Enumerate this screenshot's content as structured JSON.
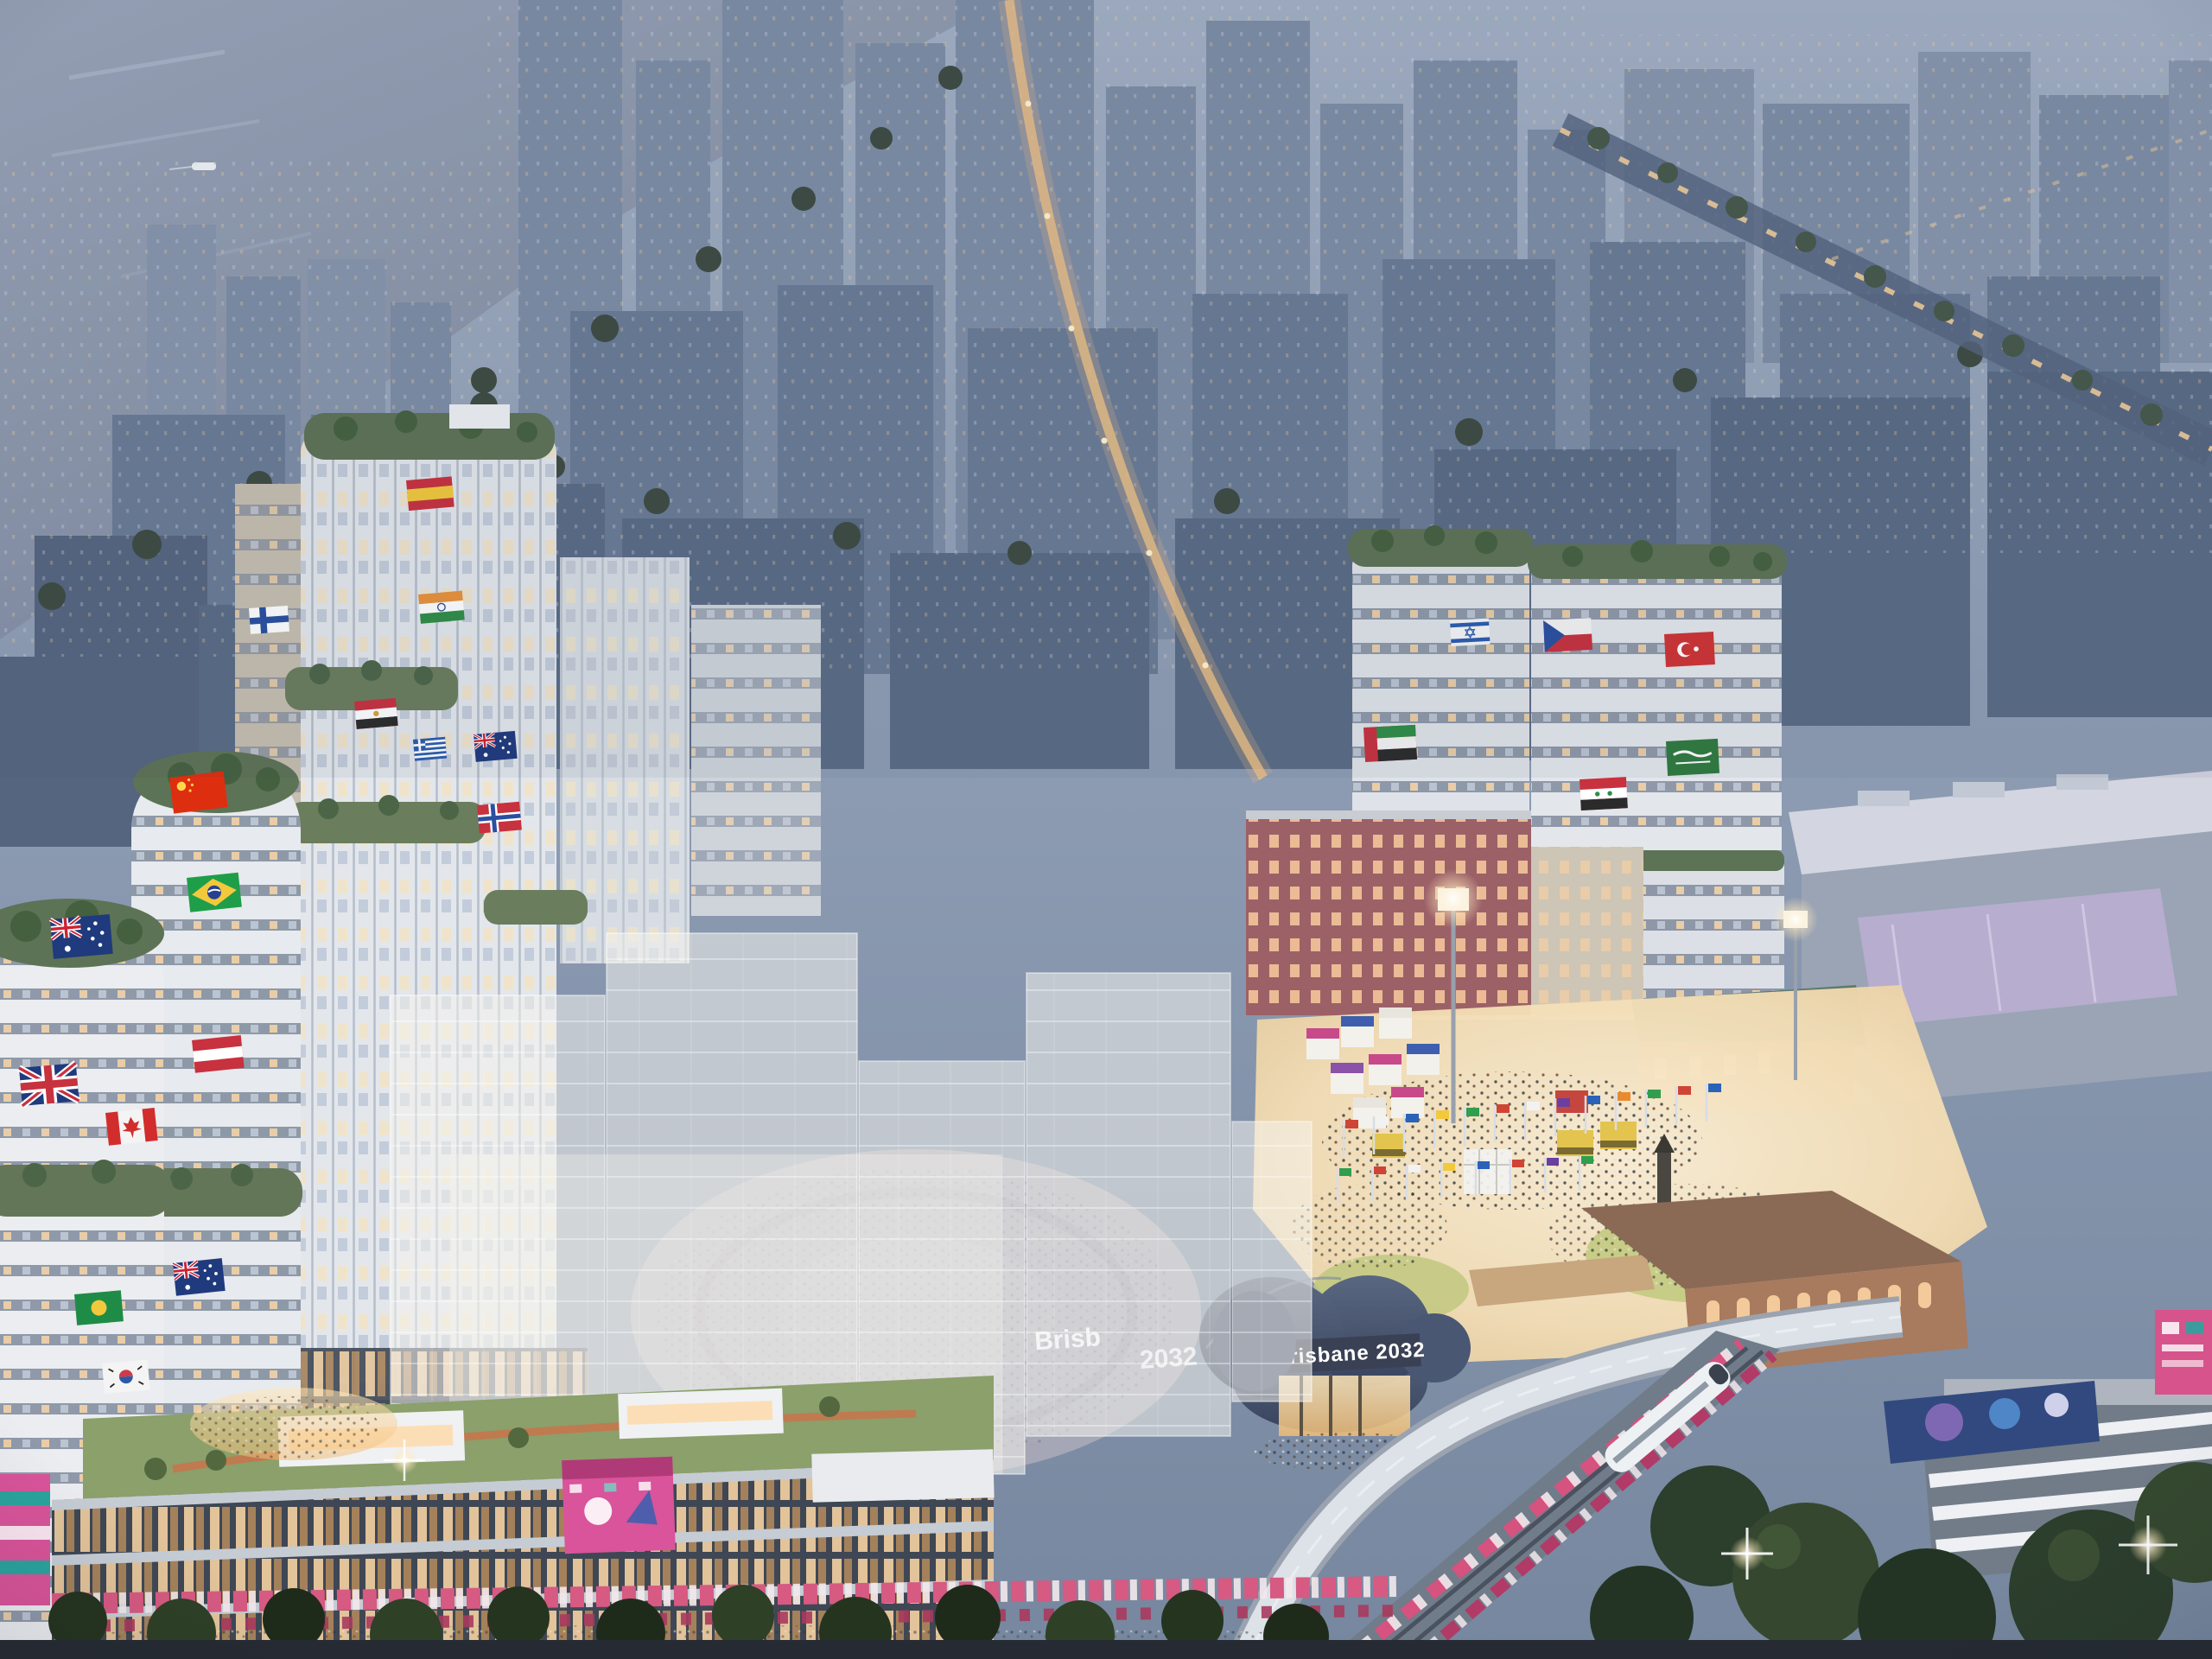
{
  "scene": {
    "type": "architectural-aerial-render",
    "description": "Aerial dusk rendering of a riverside Olympic athletes-village precinct: white residential towers draped with national flags, festival plaza with flag rows and crowds, navy arena roof with games branding, translucent massing overlay, rail corridor and branded street dressing",
    "signage": {
      "arena_banner": "Brisbane 2032",
      "ghost_banner_line1": "Brisb",
      "ghost_banner_line2": "2032"
    },
    "flags": {
      "left_tower": [
        "China",
        "Brazil",
        "Australia",
        "Austria",
        "United Kingdom",
        "Canada",
        "Australia",
        "Green and Gold",
        "South Korea"
      ],
      "mid_tower": [
        "Spain",
        "Finland",
        "India",
        "Egypt",
        "Greece",
        "Australia",
        "Norway"
      ],
      "right_towers": [
        "Israel",
        "Czech Republic",
        "Turkey",
        "United Arab Emirates",
        "Saudi Arabia",
        "Syria"
      ],
      "plaza": "rows of international flags on poles"
    },
    "palette": {
      "sky": "#8b9ab1",
      "river": "#8f9ab0",
      "city_block": "#5a6b85",
      "tower_white": "#e9ecef",
      "warm_light": "#ffd9a0",
      "arena_navy": "#3a4154",
      "brand_pink": "#d6549a",
      "lawn": "#c7cd86",
      "tree_dark": "#2c3e2c",
      "roof_green": "#5d7355"
    }
  }
}
